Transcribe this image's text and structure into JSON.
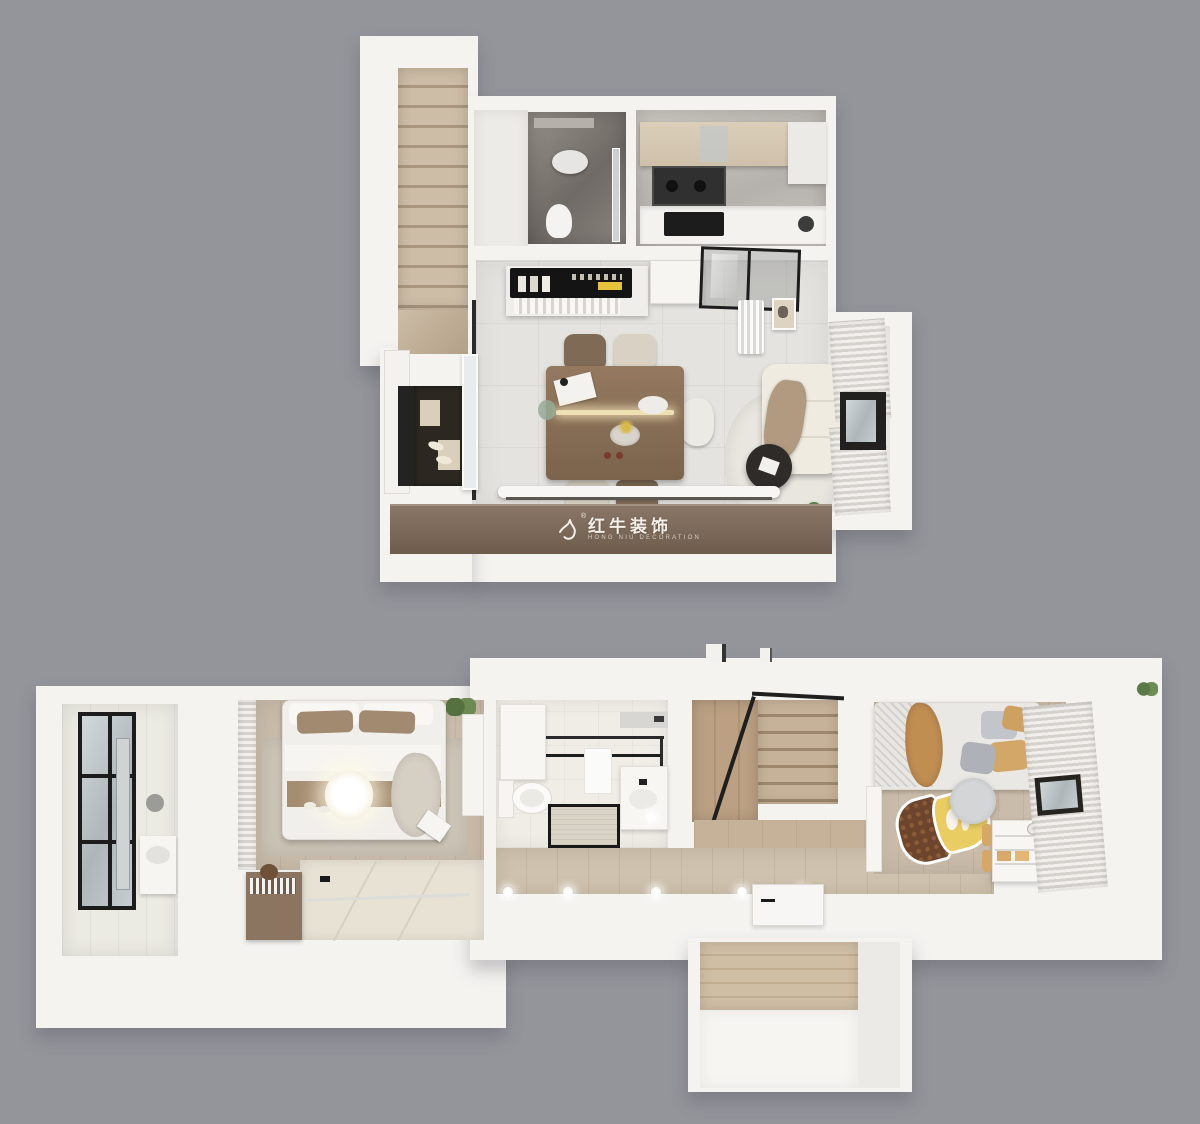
{
  "scene": {
    "kind": "3d-dollhouse-floorplan-render",
    "view": "top-down",
    "levels": [
      {
        "name": "upper-level",
        "rooms": [
          "staircase",
          "bathroom",
          "kitchen",
          "dining-area",
          "living-area",
          "entry",
          "bay-window"
        ]
      },
      {
        "name": "lower-level",
        "rooms": [
          "laundry-balcony",
          "master-bedroom",
          "tatami-wardrobe-area",
          "bathroom",
          "staircase",
          "hallway",
          "kids-bedroom",
          "entry-alcove"
        ]
      }
    ]
  },
  "watermark": {
    "brand_cn": "红牛装饰",
    "brand_en": "HONG NIU DECORATION",
    "registered": "®"
  },
  "palette": {
    "background": "#94949b",
    "wall_white": "#f4f3f0",
    "tile_floor": "#e5e3df",
    "wood_light": "#cabcaa",
    "wood_step": "#c6b298",
    "console_brown": "#7b685a",
    "marble_dark": "#7a746f",
    "sofa_cream": "#efebe0",
    "curtain_gray": "#d5d2cd",
    "railing_black": "#1f1f1f",
    "acorn_yellow": "#e9cd62",
    "acorn_brown": "#6d452c",
    "blanket_tan": "#c18e52",
    "glow_warm": "#f7f2e3"
  }
}
